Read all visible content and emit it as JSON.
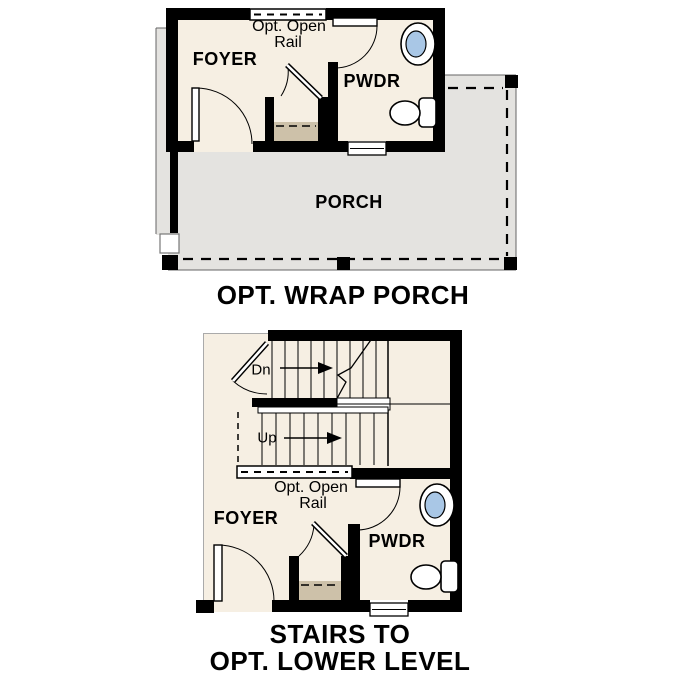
{
  "colors": {
    "wall": "#000000",
    "interior": "#f6efe3",
    "porch": "#e4e3e0",
    "closet_floor": "#cdc1a9",
    "sink_basin": "#a9c7e6",
    "linework": "#000000",
    "background": "#ffffff"
  },
  "top_plan": {
    "caption": "OPT. WRAP PORCH",
    "rooms": {
      "foyer": "FOYER",
      "powder": "PWDR",
      "porch": "PORCH"
    },
    "annotations": {
      "rail_line1": "Opt. Open",
      "rail_line2": "Rail"
    }
  },
  "bottom_plan": {
    "caption_line1": "STAIRS TO",
    "caption_line2": "OPT. LOWER LEVEL",
    "rooms": {
      "foyer": "FOYER",
      "powder": "PWDR"
    },
    "annotations": {
      "rail_line1": "Opt. Open",
      "rail_line2": "Rail",
      "stairs_down": "Dn",
      "stairs_up": "Up"
    }
  }
}
